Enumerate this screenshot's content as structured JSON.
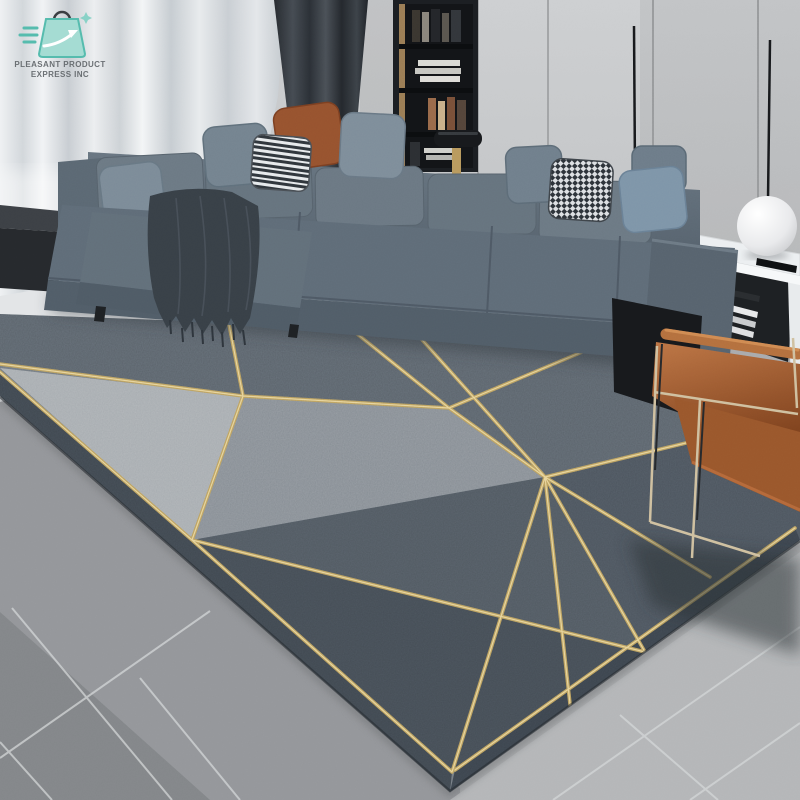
{
  "logo": {
    "line1": "PLEASANT PRODUCT",
    "line2": "EXPRESS INC",
    "icon": "shopping-bag-express-icon",
    "icon_fill": "#a5dcd3",
    "icon_outline": "#56bcae",
    "text_color": "#5f6468"
  },
  "scene": {
    "type": "lifestyle-product-photo",
    "objects": [
      "sheer-curtains",
      "dark-curtain-panel",
      "wall-panels",
      "bookshelf",
      "pendant-light-wire",
      "sectional-sofa",
      "back-cushions",
      "throw-pillows",
      "fringed-throw-blanket",
      "black-cube-side-table",
      "black-console-table",
      "brass-table-lamp",
      "white-marble-side-table",
      "sphere-lamp",
      "remote-control",
      "magazines",
      "tan-leather-armchair",
      "geometric-area-rug",
      "gray-tile-floor"
    ],
    "pillows": [
      {
        "color": "#7c8b98",
        "pattern": "solid-gray"
      },
      {
        "color": "#74838f",
        "pattern": "solid-gray"
      },
      {
        "color": "#e9ebed",
        "pattern": "black-white-stripes"
      },
      {
        "color": "#97532f",
        "pattern": "solid-rust-leather"
      },
      {
        "color": "#7e8d9a",
        "pattern": "solid-gray-blue"
      },
      {
        "color": "#707f8c",
        "pattern": "solid-gray"
      },
      {
        "color": "#dde0e3",
        "pattern": "houndstooth"
      },
      {
        "color": "#7e95a8",
        "pattern": "solid-blue"
      }
    ],
    "rug": {
      "style": "geometric-triangle-facets-with-gold-lines",
      "line_color": "#c9b06a",
      "facet_colors": [
        "#a6abaf",
        "#858c93",
        "#5a626a",
        "#4b535c",
        "#434b53",
        "#3a424b"
      ]
    },
    "palette": {
      "wall": "#c7c9cb",
      "curtain_dark": "#31363c",
      "sofa": "#5f6c78",
      "throw_blanket": "#384047",
      "chair_leather": "#b06a3c",
      "floor_light": "#b3b5b7",
      "floor_dark": "#8b8d90",
      "table_white": "#eceff1",
      "shelf": "#1b1e22",
      "lamp_sphere": "#f2f3f4"
    }
  }
}
